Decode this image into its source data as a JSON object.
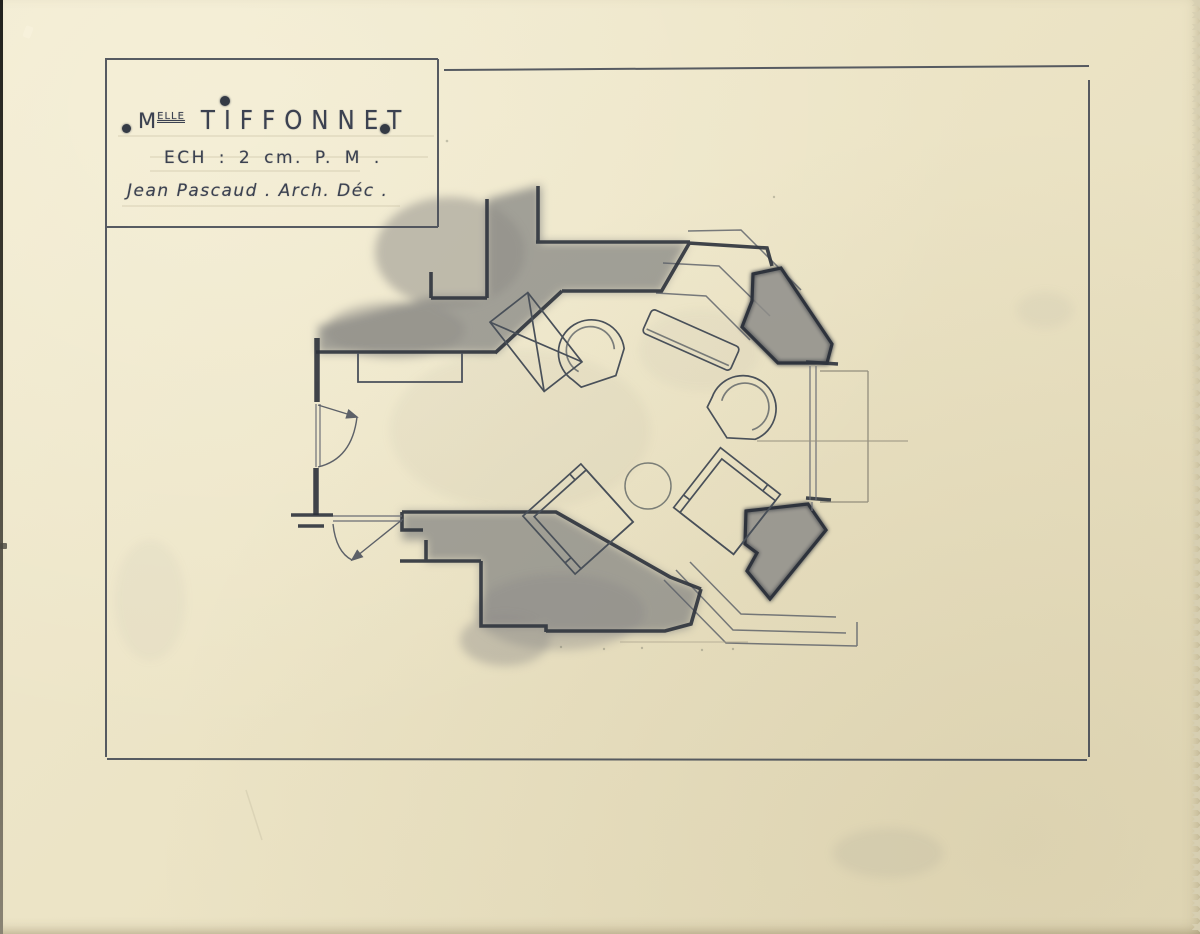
{
  "title_block": {
    "honorific": "M",
    "honorific_superscript": "ELLE",
    "client_name": "TIFFONNET",
    "scale_line": "ECH : 2 cm. P. M .",
    "author_line": "Jean Pascaud . Arch. Déc ."
  },
  "colors": {
    "paper": "#ece4c6",
    "pencil_dark": "#31363f",
    "pencil_mid": "#5d6168",
    "pencil_light": "#a29b86",
    "graphite_shading": "#8b8a86"
  }
}
